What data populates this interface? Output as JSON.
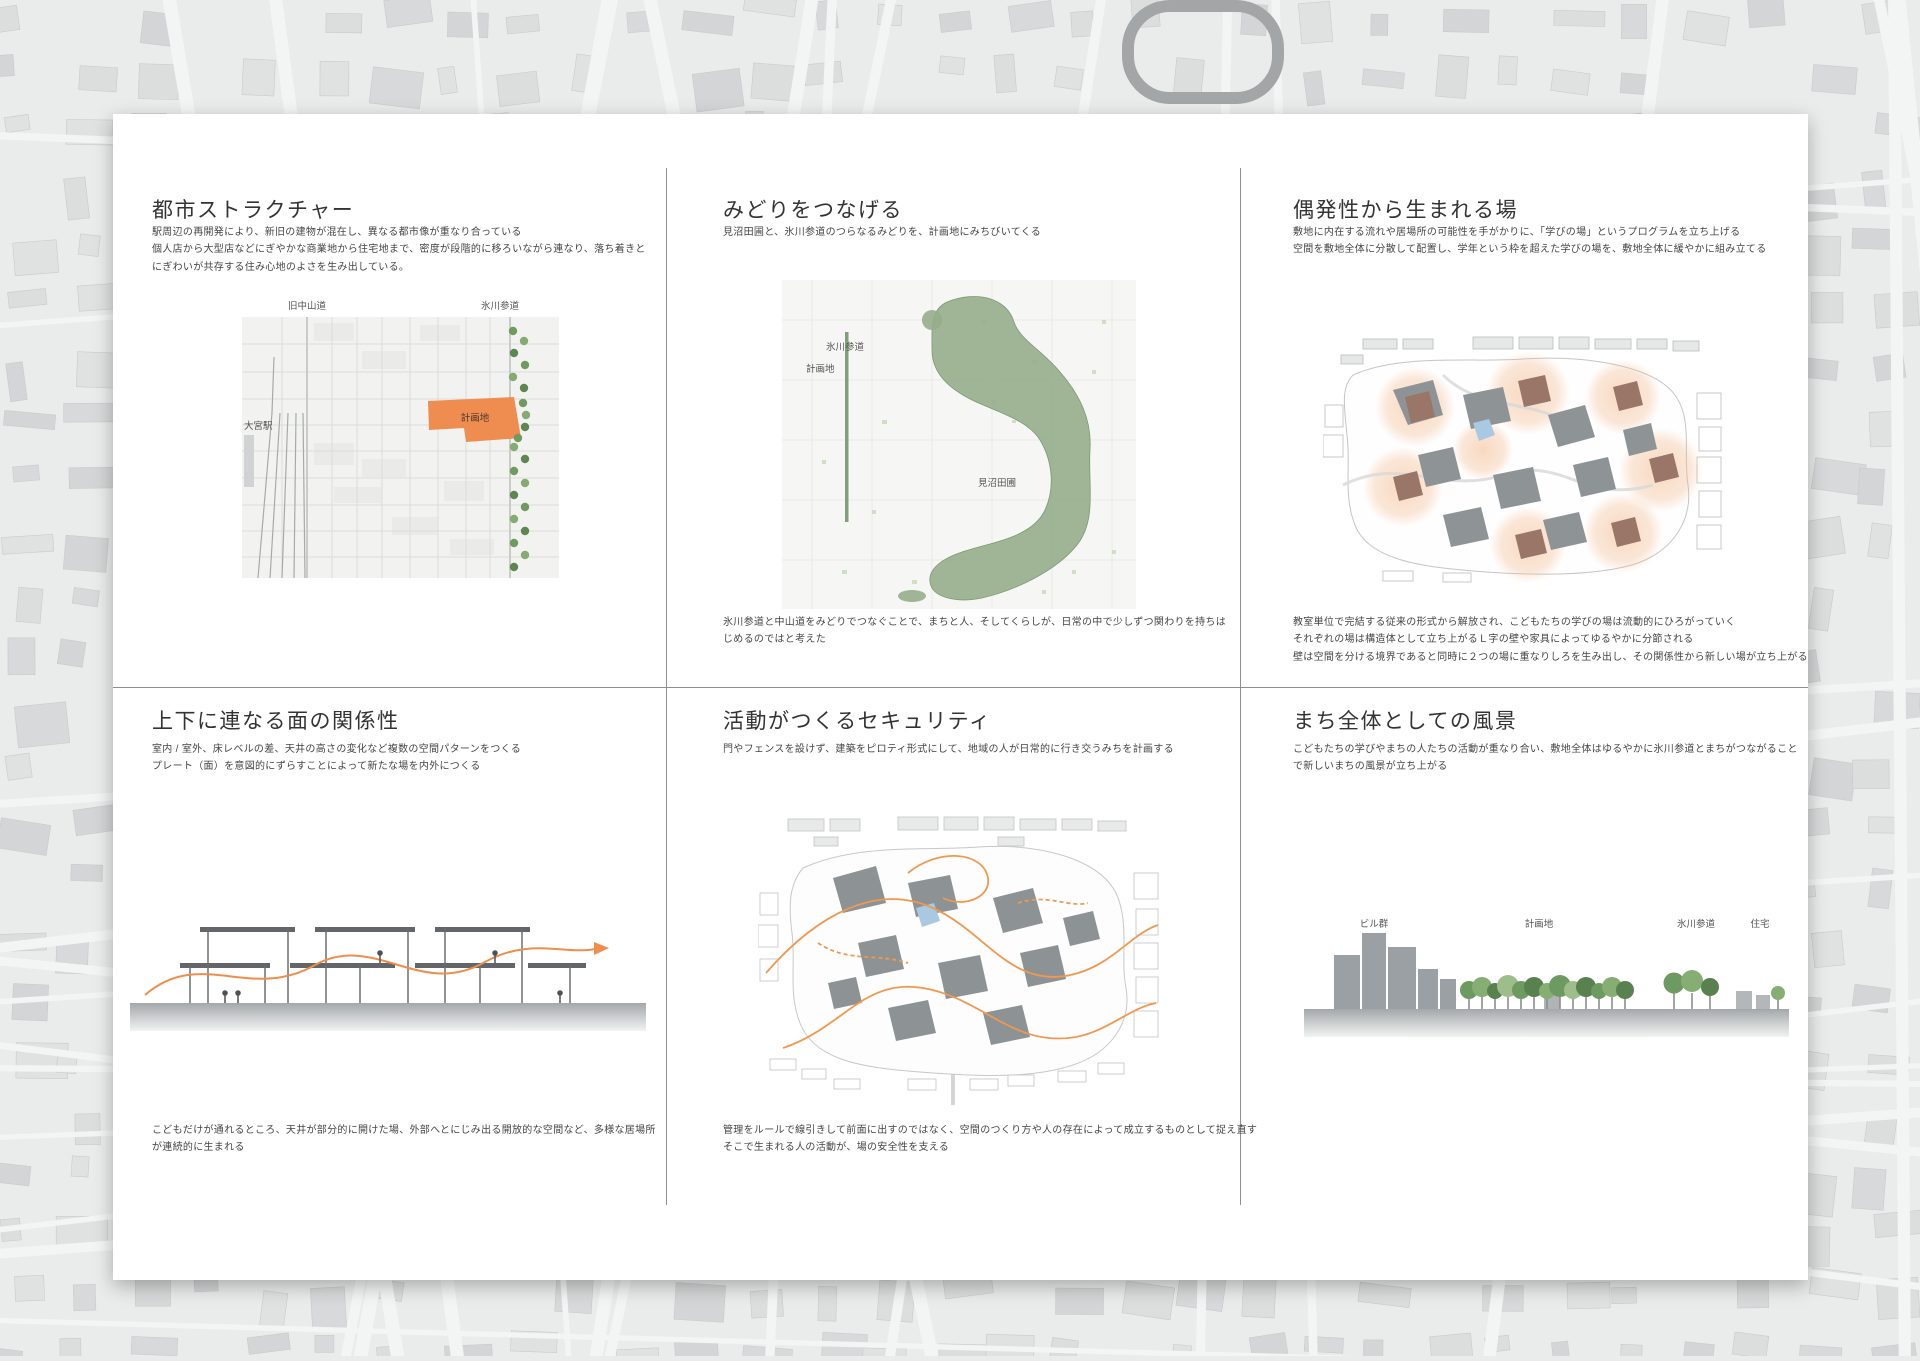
{
  "board": {
    "panels": [
      {
        "key": "urban-structure",
        "title": "都市ストラクチャー",
        "body": [
          "駅周辺の再開発により、新旧の建物が混在し、異なる都市像が重なり合っている",
          "個人店から大型店などにぎやかな商業地から住宅地まで、密度が段階的に移ろいながら連なり、落ち着きと",
          "にぎわいが共存する住み心地のよさを生み出している。"
        ],
        "map_labels": {
          "old_nakasendo": "旧中山道",
          "hikawa_sando": "氷川参道",
          "site": "計画地",
          "omiya_station": "大宮駅"
        }
      },
      {
        "key": "connect-green",
        "title": "みどりをつなげる",
        "body": [
          "見沼田圃と、氷川参道のつらなるみどりを、計画地にみちびいてくる"
        ],
        "map_labels": {
          "hikawa_sando": "氷川参道",
          "site": "計画地",
          "minuma_fields": "見沼田圃"
        },
        "footer": [
          "氷川参道と中山道をみどりでつなぐことで、まちと人、そしてくらしが、日常の中で少しずつ関わりを持ちは",
          "じめるのではと考えた"
        ]
      },
      {
        "key": "serendipity",
        "title": "偶発性から生まれる場",
        "body": [
          "敷地に内在する流れや居場所の可能性を手がかりに、「学びの場」というプログラムを立ち上げる",
          "空間を敷地全体に分散して配置し、学年という枠を超えた学びの場を、敷地全体に緩やかに組み立てる"
        ],
        "footer": [
          "教室単位で完結する従来の形式から解放され、こどもたちの学びの場は流動的にひろがっていく",
          "それぞれの場は構造体として立ち上がるＬ字の壁や家具によってゆるやかに分節される",
          "壁は空間を分ける境界であると同時に２つの場に重なりしろを生み出し、その関係性から新しい場が立ち上がる"
        ]
      },
      {
        "key": "stacked-planes",
        "title": "上下に連なる面の関係性",
        "body": [
          "室内 / 室外、床レベルの差、天井の高さの変化など複数の空間パターンをつくる",
          "プレート（面）を意図的にずらすことによって新たな場を内外につくる"
        ],
        "footer": [
          "こどもだけが通れるところ、天井が部分的に開けた場、外部へとにじみ出る開放的な空間など、多様な居場所",
          "が連続的に生まれる"
        ]
      },
      {
        "key": "activity-security",
        "title": "活動がつくるセキュリティ",
        "body": [
          "門やフェンスを設けず、建築をピロティ形式にして、地域の人が日常的に行き交うみちを計画する"
        ],
        "footer": [
          "管理をルールで線引きして前面に出すのではなく、空間のつくり方や人の存在によって成立するものとして捉え直す",
          "そこで生まれる人の活動が、場の安全性を支える"
        ]
      },
      {
        "key": "townscape",
        "title": "まち全体としての風景",
        "body": [
          "こどもたちの学びやまちの人たちの活動が重なり合い、敷地全体はゆるやかに氷川参道とまちがつながること",
          "で新しいまちの風景が立ち上がる"
        ],
        "diagram_labels": {
          "buildings": "ビル群",
          "site": "計画地",
          "hikawa_sando": "氷川参道",
          "houses": "住宅"
        }
      }
    ],
    "colors": {
      "site_orange": "#EF8C4F",
      "flow_orange": "#EE8E4B",
      "green_dark": "#6C9A60",
      "green_mass": "#96AD8C",
      "roof_brown": "#9A7668",
      "building_gray": "#8E9395",
      "pond_blue": "#A9C9E2"
    }
  }
}
